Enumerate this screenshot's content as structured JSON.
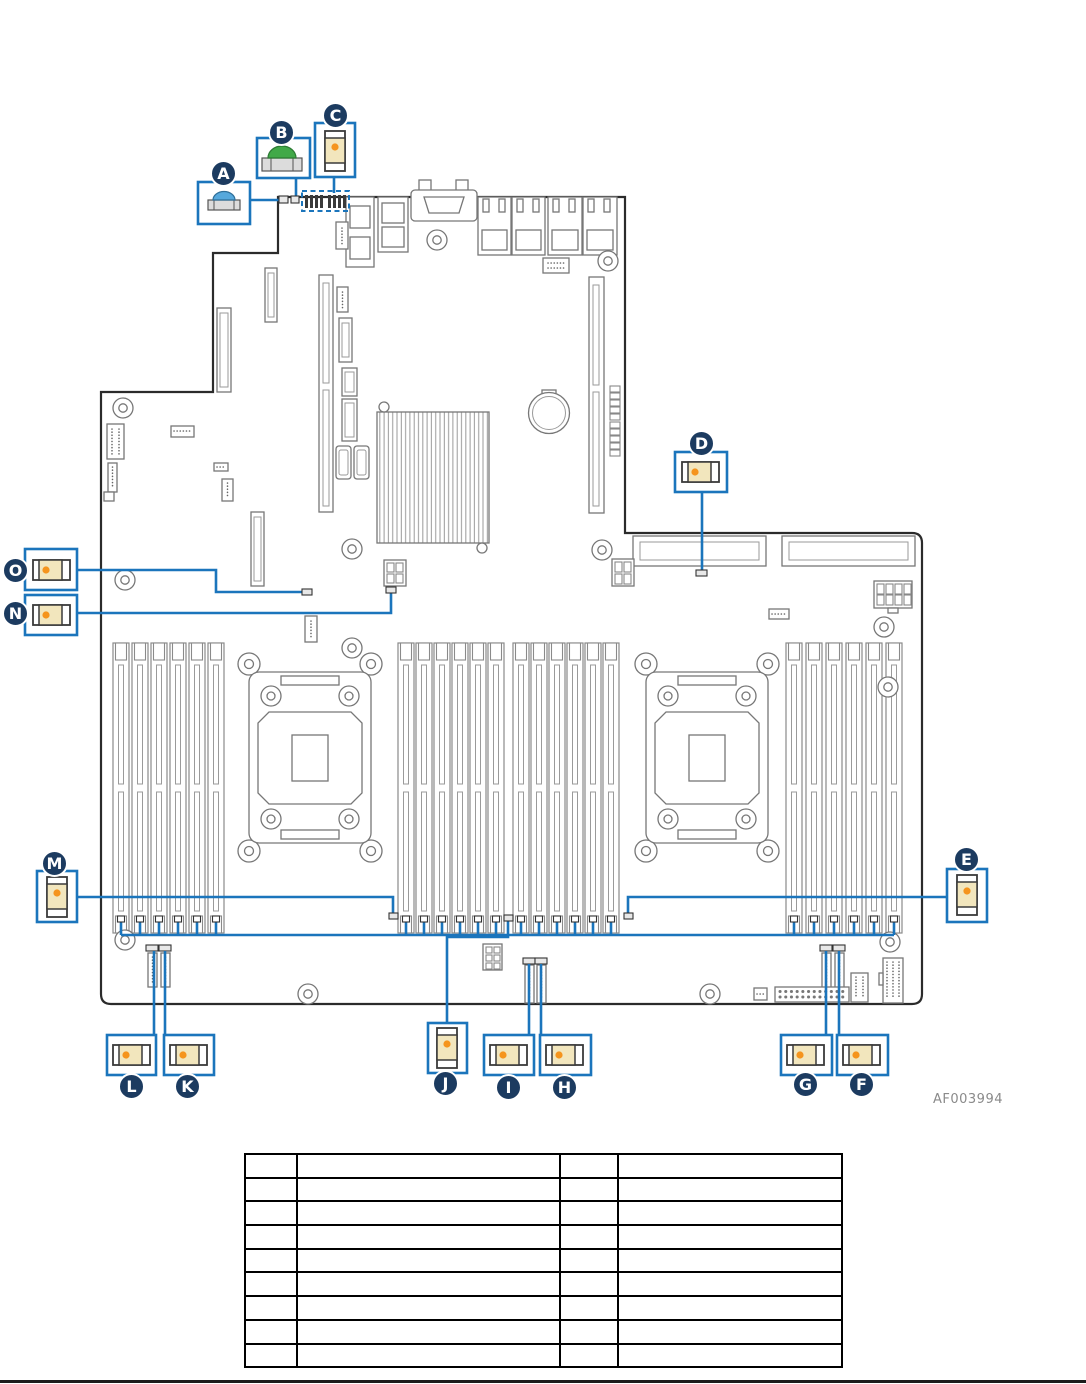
{
  "figure": {
    "code": "AF003994",
    "type": "motherboard-jumper-and-button-location-diagram",
    "callouts": [
      {
        "letter": "A",
        "target": "blue-push-button"
      },
      {
        "letter": "B",
        "target": "green-push-button"
      },
      {
        "letter": "C",
        "target": "vertical-jumper-block"
      },
      {
        "letter": "D",
        "target": "horizontal-jumper-block"
      },
      {
        "letter": "E",
        "target": "vertical-jumper-block"
      },
      {
        "letter": "F",
        "target": "horizontal-jumper-block"
      },
      {
        "letter": "G",
        "target": "horizontal-jumper-block"
      },
      {
        "letter": "H",
        "target": "horizontal-jumper-block"
      },
      {
        "letter": "I",
        "target": "horizontal-jumper-block"
      },
      {
        "letter": "J",
        "target": "vertical-jumper-block"
      },
      {
        "letter": "K",
        "target": "horizontal-jumper-block"
      },
      {
        "letter": "L",
        "target": "horizontal-jumper-block"
      },
      {
        "letter": "M",
        "target": "vertical-jumper-block"
      },
      {
        "letter": "N",
        "target": "horizontal-jumper-block"
      },
      {
        "letter": "O",
        "target": "horizontal-jumper-block"
      }
    ],
    "colors": {
      "callout_blue": "#1b75bc",
      "badge_navy": "#1c3b60",
      "jumper_body_tan": "#f2e6bd",
      "jumper_pin_orange": "#f5941d",
      "button_blue": "#56a8dc",
      "button_green": "#41a948"
    }
  },
  "legend_table": {
    "rows": 9,
    "columns": 4,
    "cells": [
      [
        "",
        "",
        "",
        ""
      ],
      [
        "",
        "",
        "",
        ""
      ],
      [
        "",
        "",
        "",
        ""
      ],
      [
        "",
        "",
        "",
        ""
      ],
      [
        "",
        "",
        "",
        ""
      ],
      [
        "",
        "",
        "",
        ""
      ],
      [
        "",
        "",
        "",
        ""
      ],
      [
        "",
        "",
        "",
        ""
      ],
      [
        "",
        "",
        "",
        ""
      ]
    ]
  }
}
